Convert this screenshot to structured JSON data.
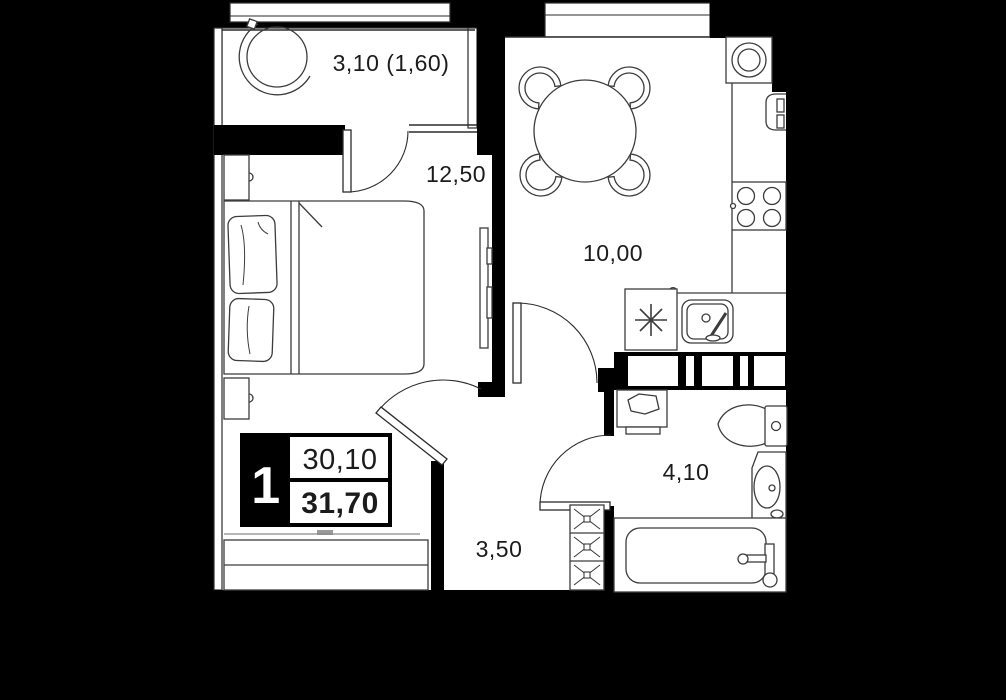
{
  "plan": {
    "background_color": "#000000",
    "floor_color": "#ffffff",
    "wall_color": "#000000",
    "furniture_line_color": "#3c3c3c",
    "rooms": [
      {
        "id": "balcony",
        "area_label": "3,10 (1,60)"
      },
      {
        "id": "bedroom",
        "area_label": "12,50"
      },
      {
        "id": "kitchen",
        "area_label": "10,00"
      },
      {
        "id": "bathroom",
        "area_label": "4,10"
      },
      {
        "id": "hallway",
        "area_label": "3,50"
      }
    ],
    "info_badge": {
      "rooms_count": "1",
      "living_area": "30,10",
      "total_area": "31,70"
    },
    "furniture_icons": [
      "drying-rack-icon",
      "double-bed-icon",
      "pillow-icon",
      "nightstand-icon",
      "tv-icon",
      "wardrobe-icon",
      "dining-table-icon",
      "chair-icon",
      "kitchen-sink-icon",
      "fridge-icon",
      "stove-icon",
      "washing-machine-icon",
      "sink-faucet-icon",
      "vent-shaft-icon",
      "bathroom-cabinet-icon",
      "toilet-icon",
      "washbasin-icon",
      "bathtub-icon"
    ]
  }
}
